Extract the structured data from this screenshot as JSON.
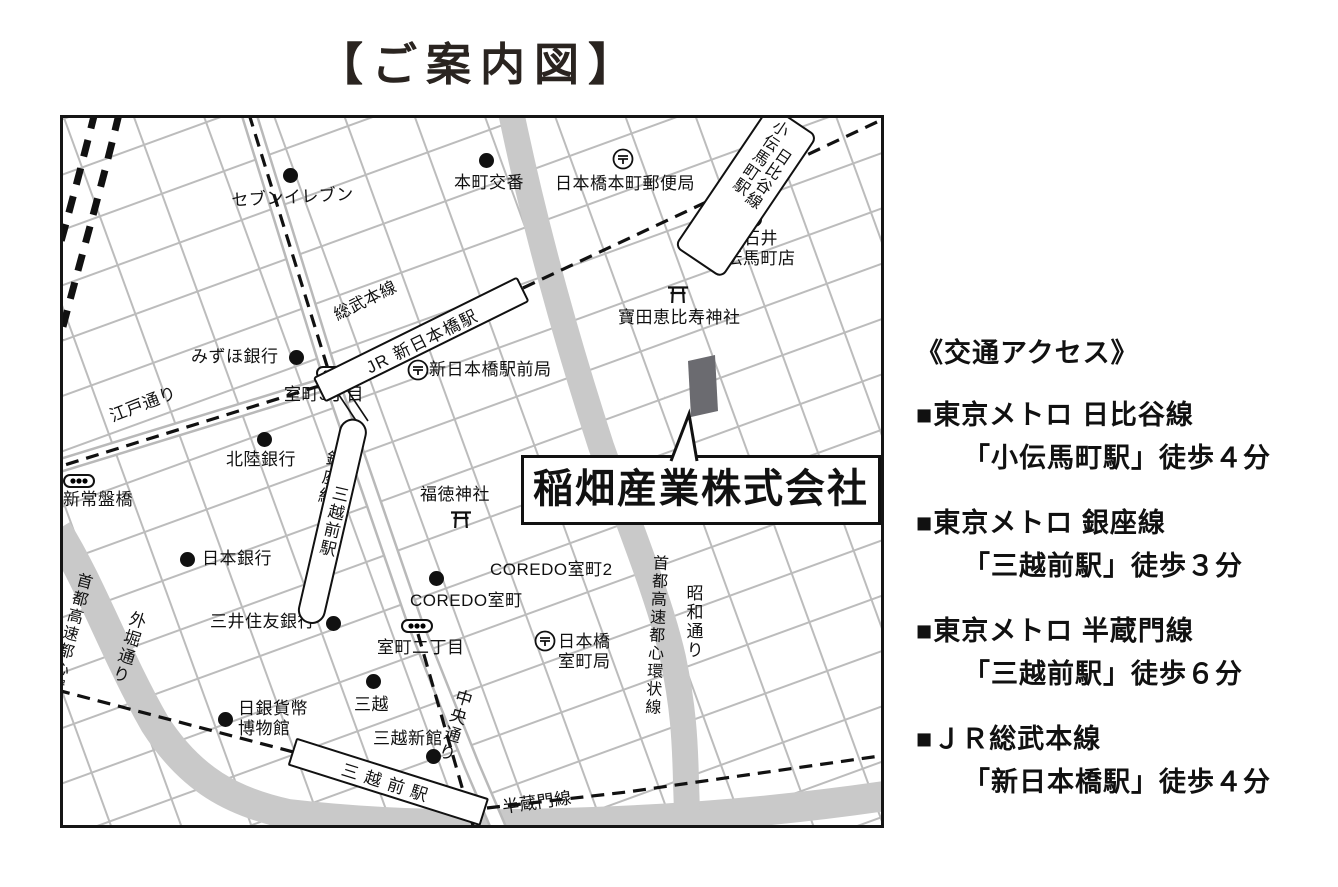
{
  "title": "【ご案内図】",
  "map": {
    "company": {
      "name": "稲畑産業株式会社"
    },
    "stations": {
      "sobu_line_label": "総武本線",
      "jr_shin_nihombashi": "JR 新日本橋駅",
      "kodemmacho_station": "小伝馬町駅",
      "hibiya_line": "日比谷線",
      "ginza_line": "銀座線",
      "mitsukoshimae_ginza": "三越前駅",
      "mitsukoshimae_hanzomon": "三越前駅",
      "hanzomon_line": "半蔵門線"
    },
    "roads": {
      "edo_dori": "江戸通り",
      "sotobori_dori": "外堀通り",
      "chuo_dori": "中央通り",
      "showa_dori": "昭和通り",
      "shuto_expwy_left": "首都高速都心環状線",
      "shuto_expwy_center": "首都高速都心環状線"
    },
    "landmarks": {
      "seven_eleven": "セブンイレブン",
      "honcho_koban": "本町交番",
      "honcho_post_office": "日本橋本町郵便局",
      "seijo_ishii": "成城石井\n小伝馬町店",
      "takarada_ebisu": "寶田恵比寿神社",
      "mizuho_bank": "みずほ銀行",
      "muromachi_3chome": "室町3丁目",
      "shin_nihombashi_post_office": "新日本橋駅前局",
      "hokuriku_bank": "北陸銀行",
      "shin_tokiwabashi": "新常盤橋",
      "fukutoku_shrine": "福徳神社",
      "bank_of_japan": "日本銀行",
      "coredo_muromachi_2": "COREDO室町2",
      "coredo_muromachi": "COREDO室町",
      "smbc_bank": "三井住友銀行",
      "muromachi_2chome": "室町二丁目",
      "nihombashi_muromachi_post_office": "日本橋\n室町局",
      "nichigin_museum": "日銀貨幣\n博物館",
      "mitsukoshi": "三越",
      "mitsukoshi_annex": "三越新館"
    }
  },
  "access": {
    "heading": "《交通アクセス》",
    "items": [
      {
        "bullet": "■",
        "line": "東京メトロ 日比谷線",
        "walk": "「小伝馬町駅」徒歩４分"
      },
      {
        "bullet": "■",
        "line": "東京メトロ 銀座線",
        "walk": "「三越前駅」徒歩３分"
      },
      {
        "bullet": "■",
        "line": "東京メトロ 半蔵門線",
        "walk": "「三越前駅」徒歩６分"
      },
      {
        "bullet": "■",
        "line": "ＪＲ総武本線",
        "walk": "「新日本橋駅」徒歩４分"
      }
    ]
  }
}
